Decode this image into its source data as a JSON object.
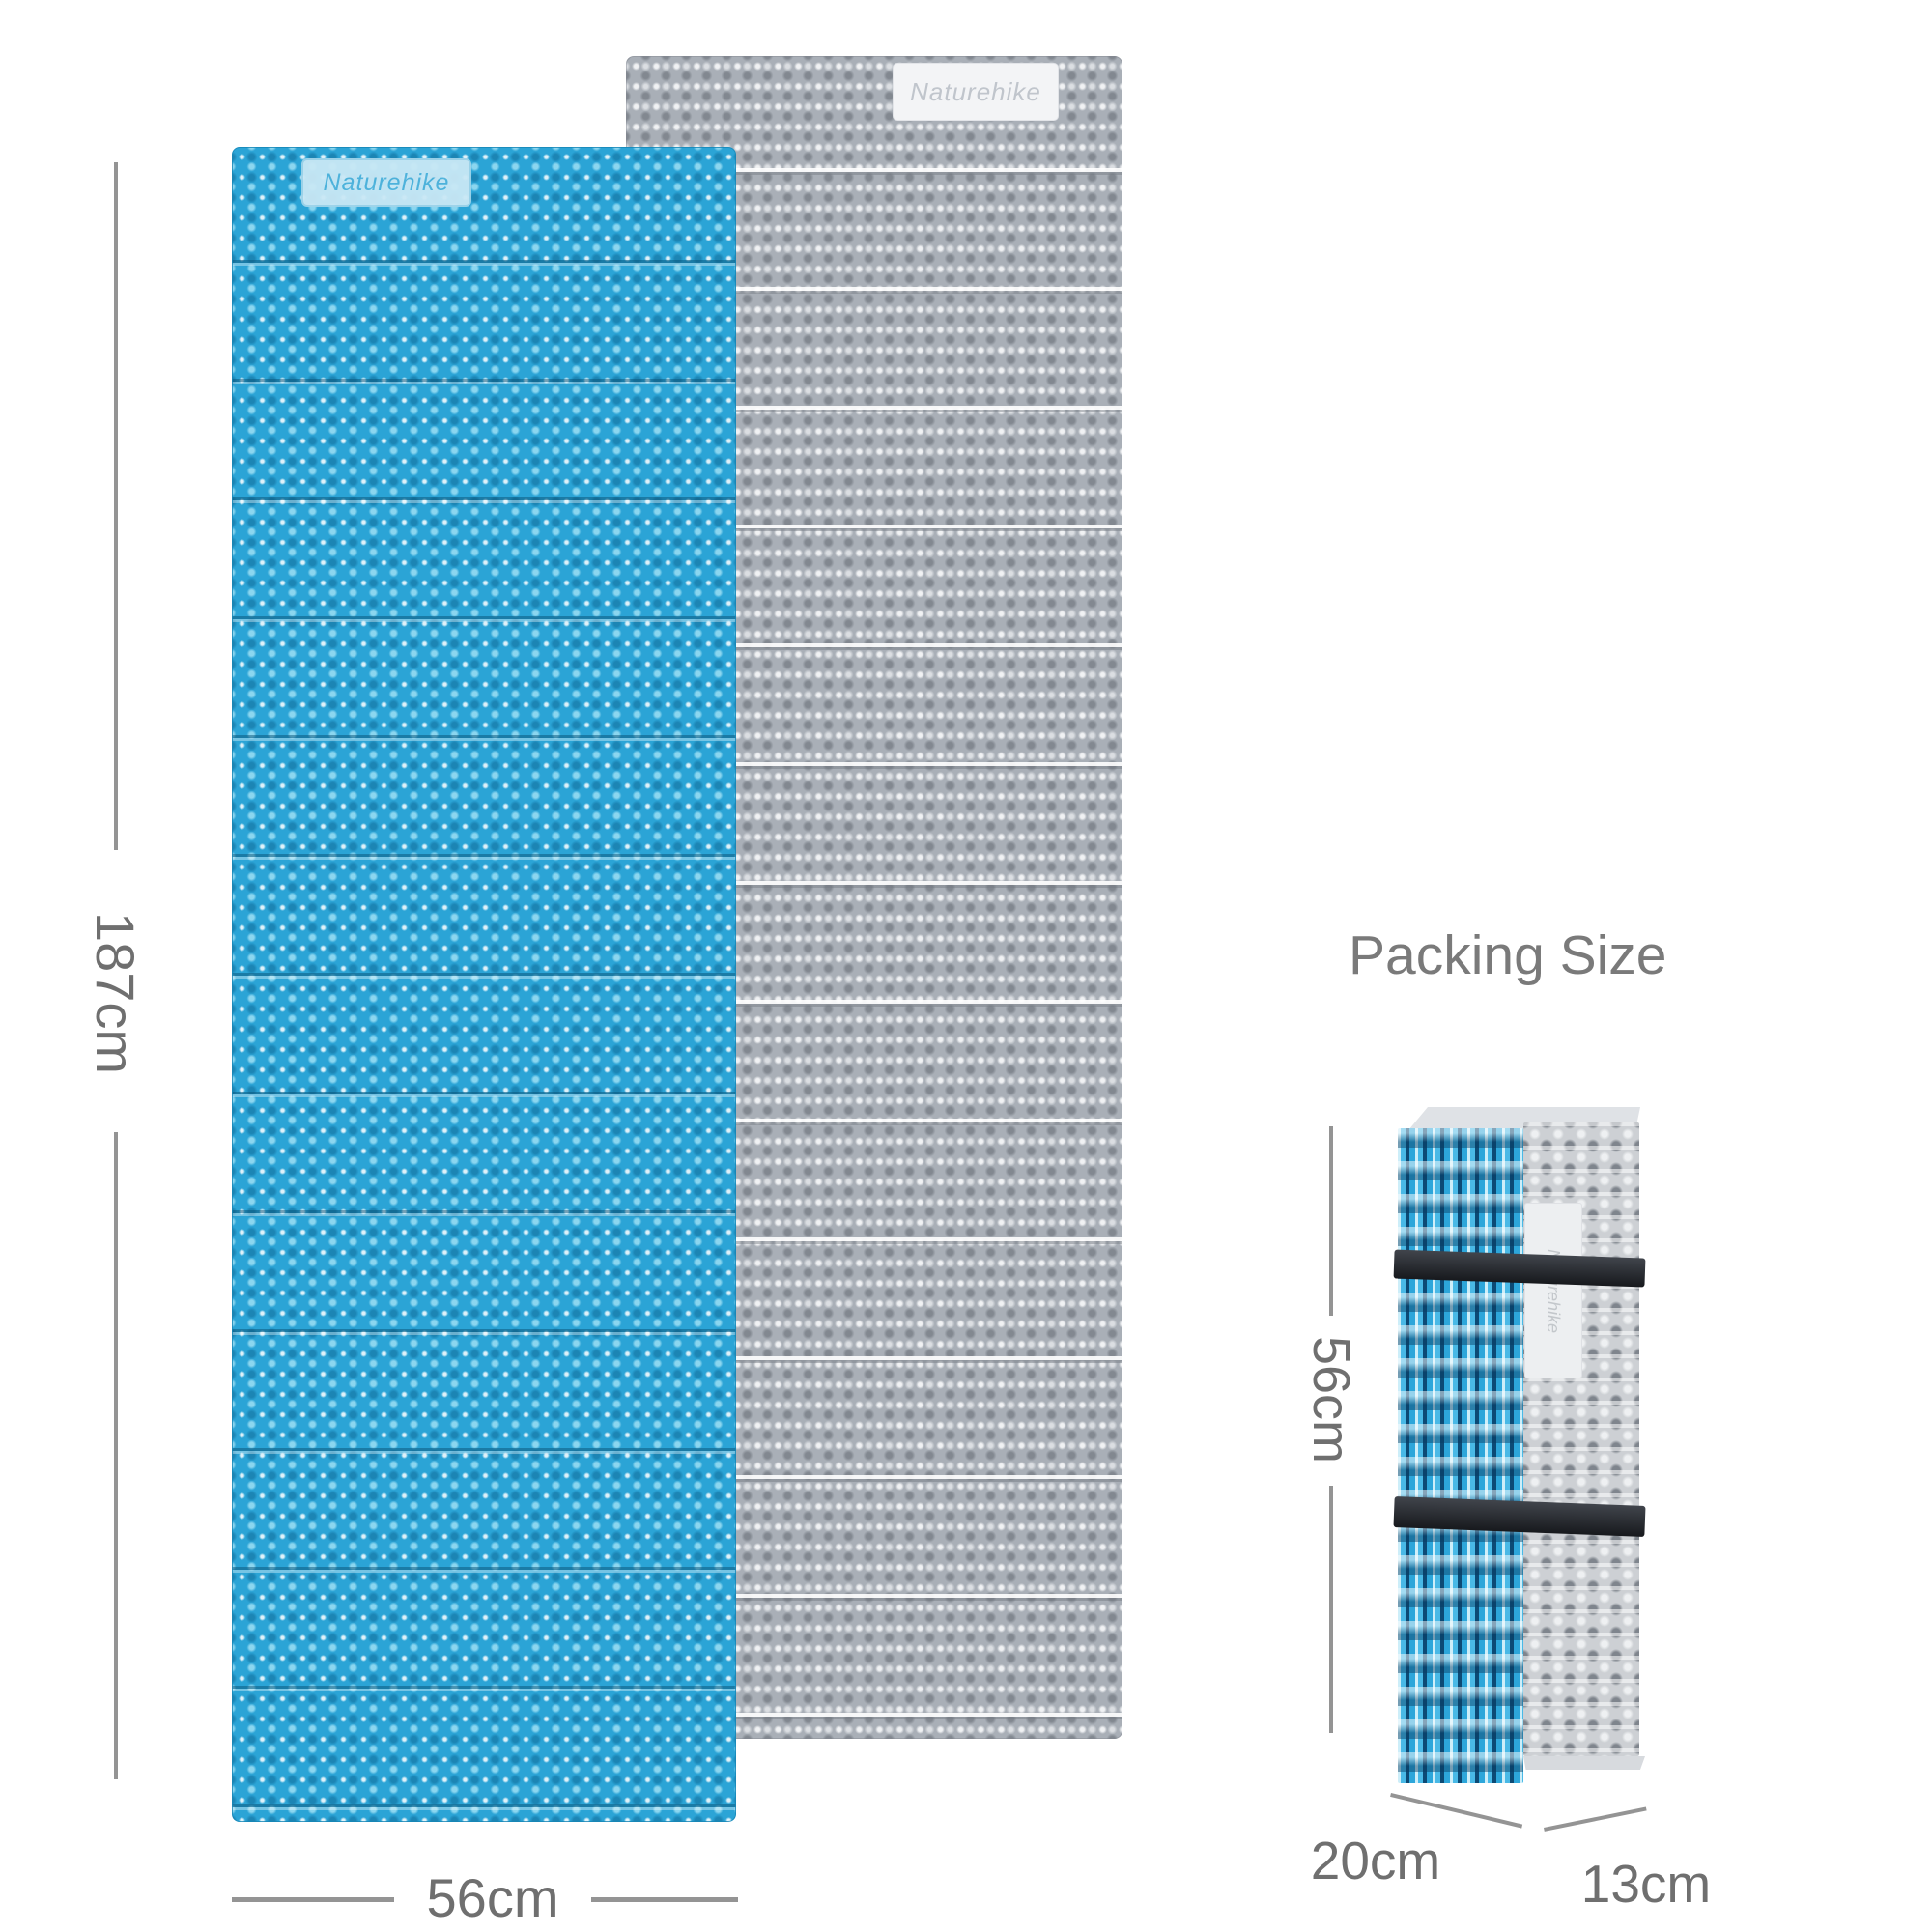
{
  "brand": {
    "name": "Naturehike"
  },
  "colors": {
    "bg": "#ffffff",
    "blue": "#2ba4d6",
    "gray": "#a9afb7",
    "navy_accent": "#0c4a75",
    "strap": "#1e2125",
    "dimension_text": "#6f6f6f",
    "dimension_line": "#949494",
    "title_text": "#7a7a7a"
  },
  "unfolded_view": {
    "length_label": "187cm",
    "width_label": "56cm"
  },
  "packing_view": {
    "title": "Packing Size",
    "height_label": "56cm",
    "depth_label": "20cm",
    "width_label": "13cm"
  }
}
